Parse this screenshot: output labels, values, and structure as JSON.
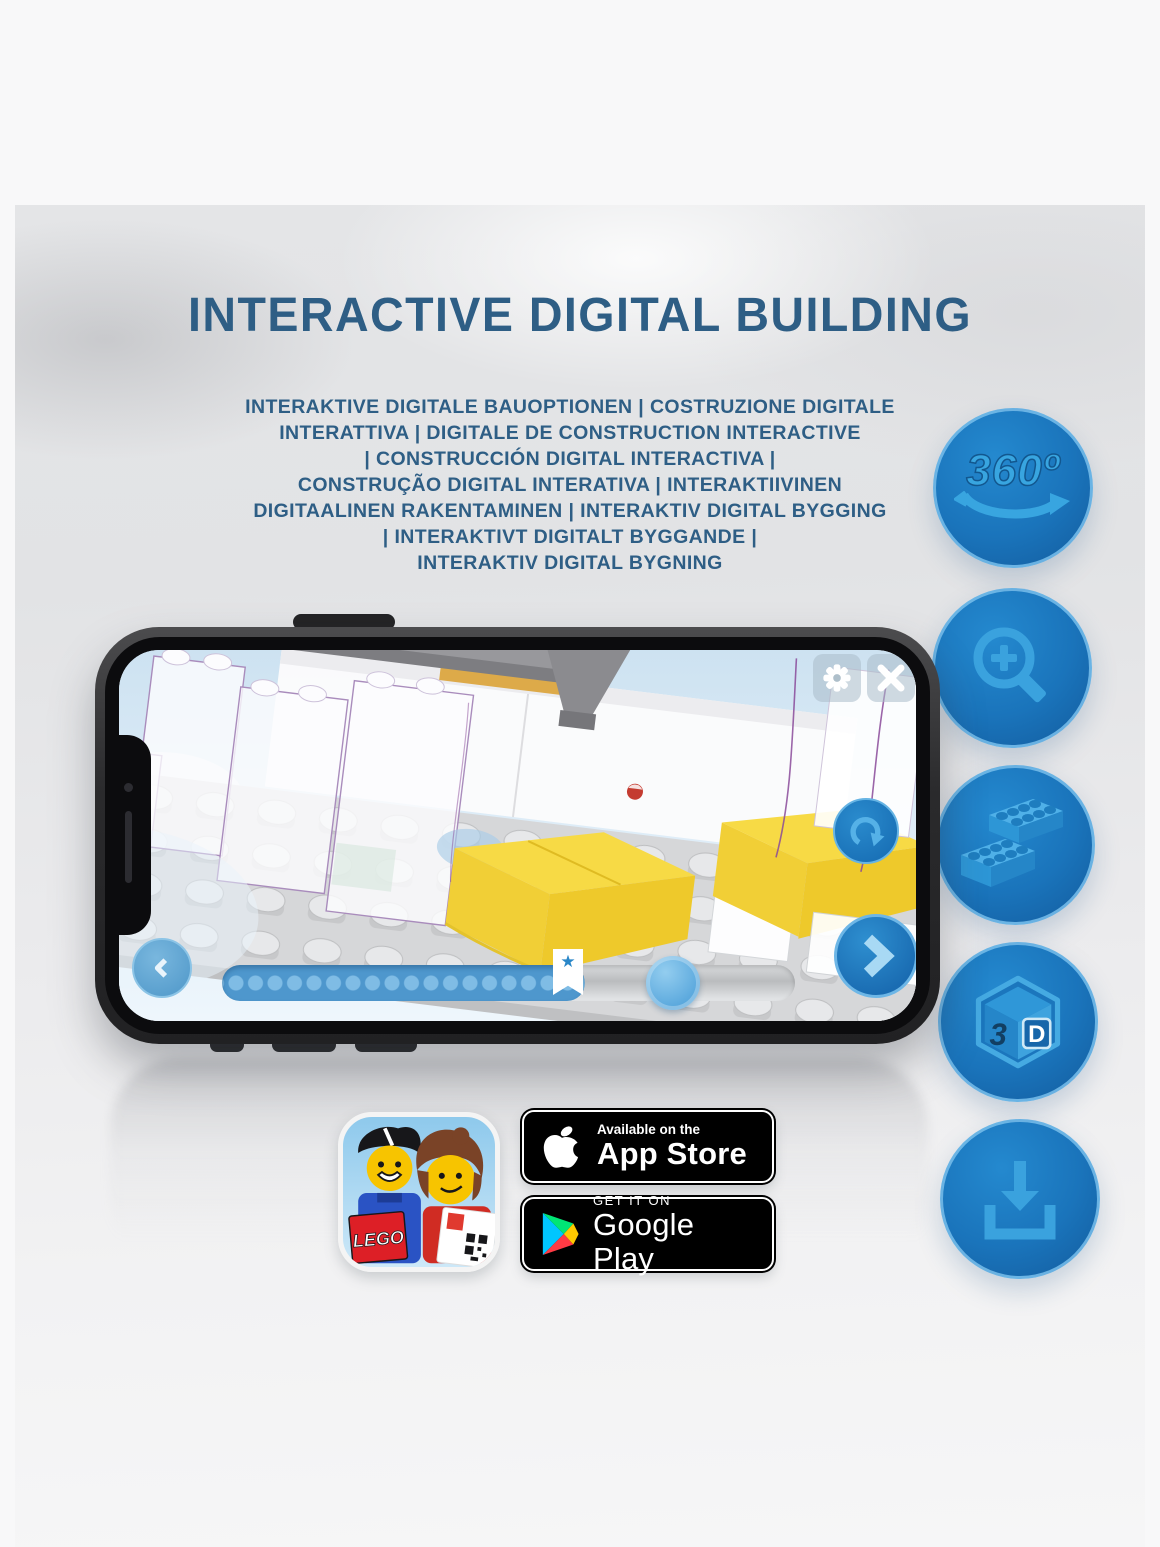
{
  "hero": {
    "title": "INTERACTIVE DIGITAL BUILDING",
    "subtitle_lines": [
      "INTERAKTIVE DIGITALE BAUOPTIONEN | COSTRUZIONE DIGITALE",
      "INTERATTIVA | DIGITALE DE CONSTRUCTION INTERACTIVE",
      "| CONSTRUCCIÓN DIGITAL INTERACTIVA |",
      "CONSTRUÇÃO DIGITAL INTERATIVA | INTERAKTIIVINEN",
      "DIGITAALINEN RAKENTAMINEN | INTERAKTIV DIGITAL BYGGING",
      "| INTERAKTIVT DIGITALT BYGGANDE |",
      "INTERAKTIV DIGITAL BYGNING"
    ]
  },
  "features": [
    {
      "id": "rotation-360-icon",
      "label": "360º"
    },
    {
      "id": "zoom-in-icon"
    },
    {
      "id": "brick-building-icon"
    },
    {
      "id": "3d-view-icon",
      "left_face": "3",
      "right_face": "D"
    },
    {
      "id": "download-icon"
    }
  ],
  "phone_app": {
    "progress_percent": 62,
    "star_marker_percent": 42,
    "star_glyph": "★"
  },
  "store_badges": {
    "app_store": {
      "line1": "Available on the",
      "line2": "App Store"
    },
    "google_play": {
      "line1": "GET IT ON",
      "line2": "Google Play"
    },
    "lego_app_icon": {
      "logo": "LEGO"
    }
  },
  "colors": {
    "heading_blue": "#2e5e85",
    "circle_blue": "#1a74bb",
    "glyph_blue": "#38a5e0",
    "progress_fill": "#4e97cd",
    "badge_black": "#000000"
  }
}
